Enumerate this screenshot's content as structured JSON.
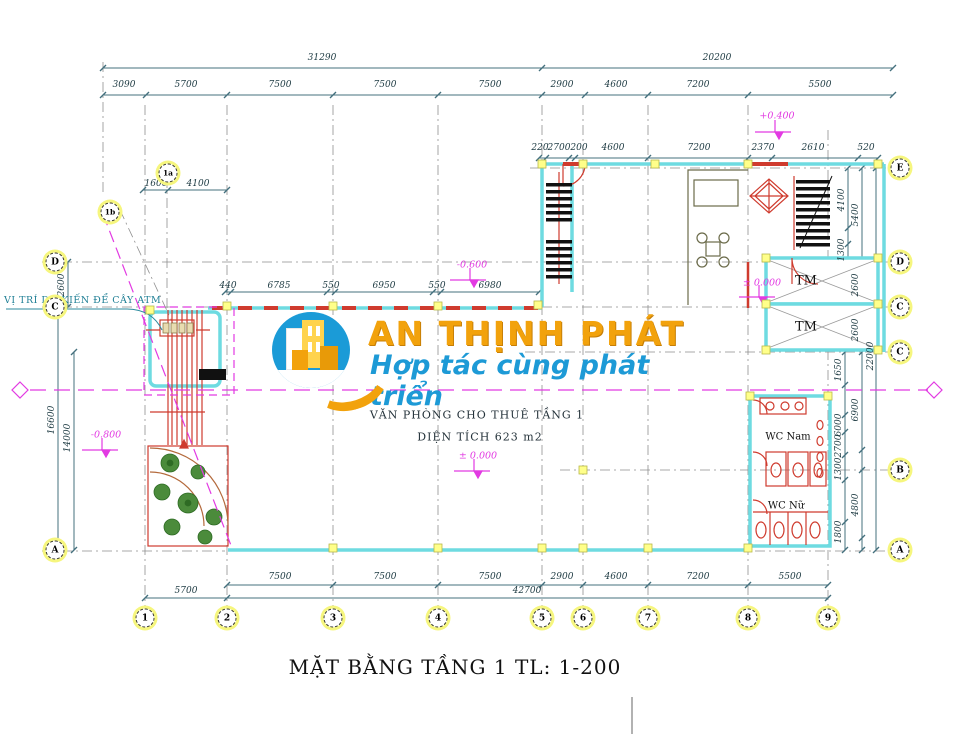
{
  "plan": {
    "title": "MẶT BẰNG TẦNG 1 TL: 1-200",
    "room_name": "VĂN PHÒNG CHO THUÊ TẦNG 1",
    "room_area": "DIỆN TÍCH 623 m2",
    "atm_note": "VỊ TRÍ DỰ KIẾN ĐỂ CÂY ATM",
    "labels": {
      "elevator1": "TM",
      "elevator2": "TM",
      "wc_men": "WC Nam",
      "wc_women": "WC Nữ"
    },
    "elevations": {
      "plus0400": "+0.400",
      "minus0600": "-0.600",
      "zero_lobby": "± 0.000",
      "zero_office": "± 0.000",
      "minus0800": "-0.800"
    }
  },
  "watermark": {
    "name": "AN THỊNH PHÁT",
    "slogan": "Hợp tác cùng phát triển",
    "orange": "#f2a20c",
    "blue": "#1d9ad6"
  },
  "grid_bubbles": {
    "bottom": [
      "1",
      "2",
      "3",
      "4",
      "5",
      "6",
      "7",
      "8",
      "9"
    ],
    "right": [
      "E",
      "D",
      "C",
      "C",
      "B",
      "A"
    ],
    "left": [
      "D",
      "C",
      "A"
    ],
    "top": [
      "1a",
      "1b"
    ]
  },
  "dims": {
    "top_total": [
      "31290",
      "20200"
    ],
    "top_row": [
      "3090",
      "5700",
      "7500",
      "7500",
      "7500",
      "2900",
      "4600",
      "7200",
      "5500"
    ],
    "second_row": [
      "220",
      "2700",
      "200",
      "4600",
      "7200",
      "2370",
      "2610",
      "520"
    ],
    "inner_top": [
      "1600",
      "4100"
    ],
    "mid_row": [
      "440",
      "6785",
      "550",
      "6950",
      "550",
      "6980"
    ],
    "bottom_row": [
      "7500",
      "7500",
      "7500",
      "2900",
      "4600",
      "7200",
      "5500"
    ],
    "bottom_row2": [
      "5700",
      "42700"
    ],
    "left_col": [
      "2600",
      "16600",
      "14000"
    ],
    "right_col": [
      "4100",
      "5400",
      "1300",
      "2600",
      "2600",
      "22000",
      "1650",
      "6900",
      "6000",
      "2700",
      "1300",
      "4800",
      "1800"
    ]
  },
  "colors": {
    "wall": "#6edbe1",
    "dimension": "#44707e",
    "magenta": "#e23ae2",
    "red": "#cf3b2e",
    "grid_yellow": "#ffff8a"
  }
}
